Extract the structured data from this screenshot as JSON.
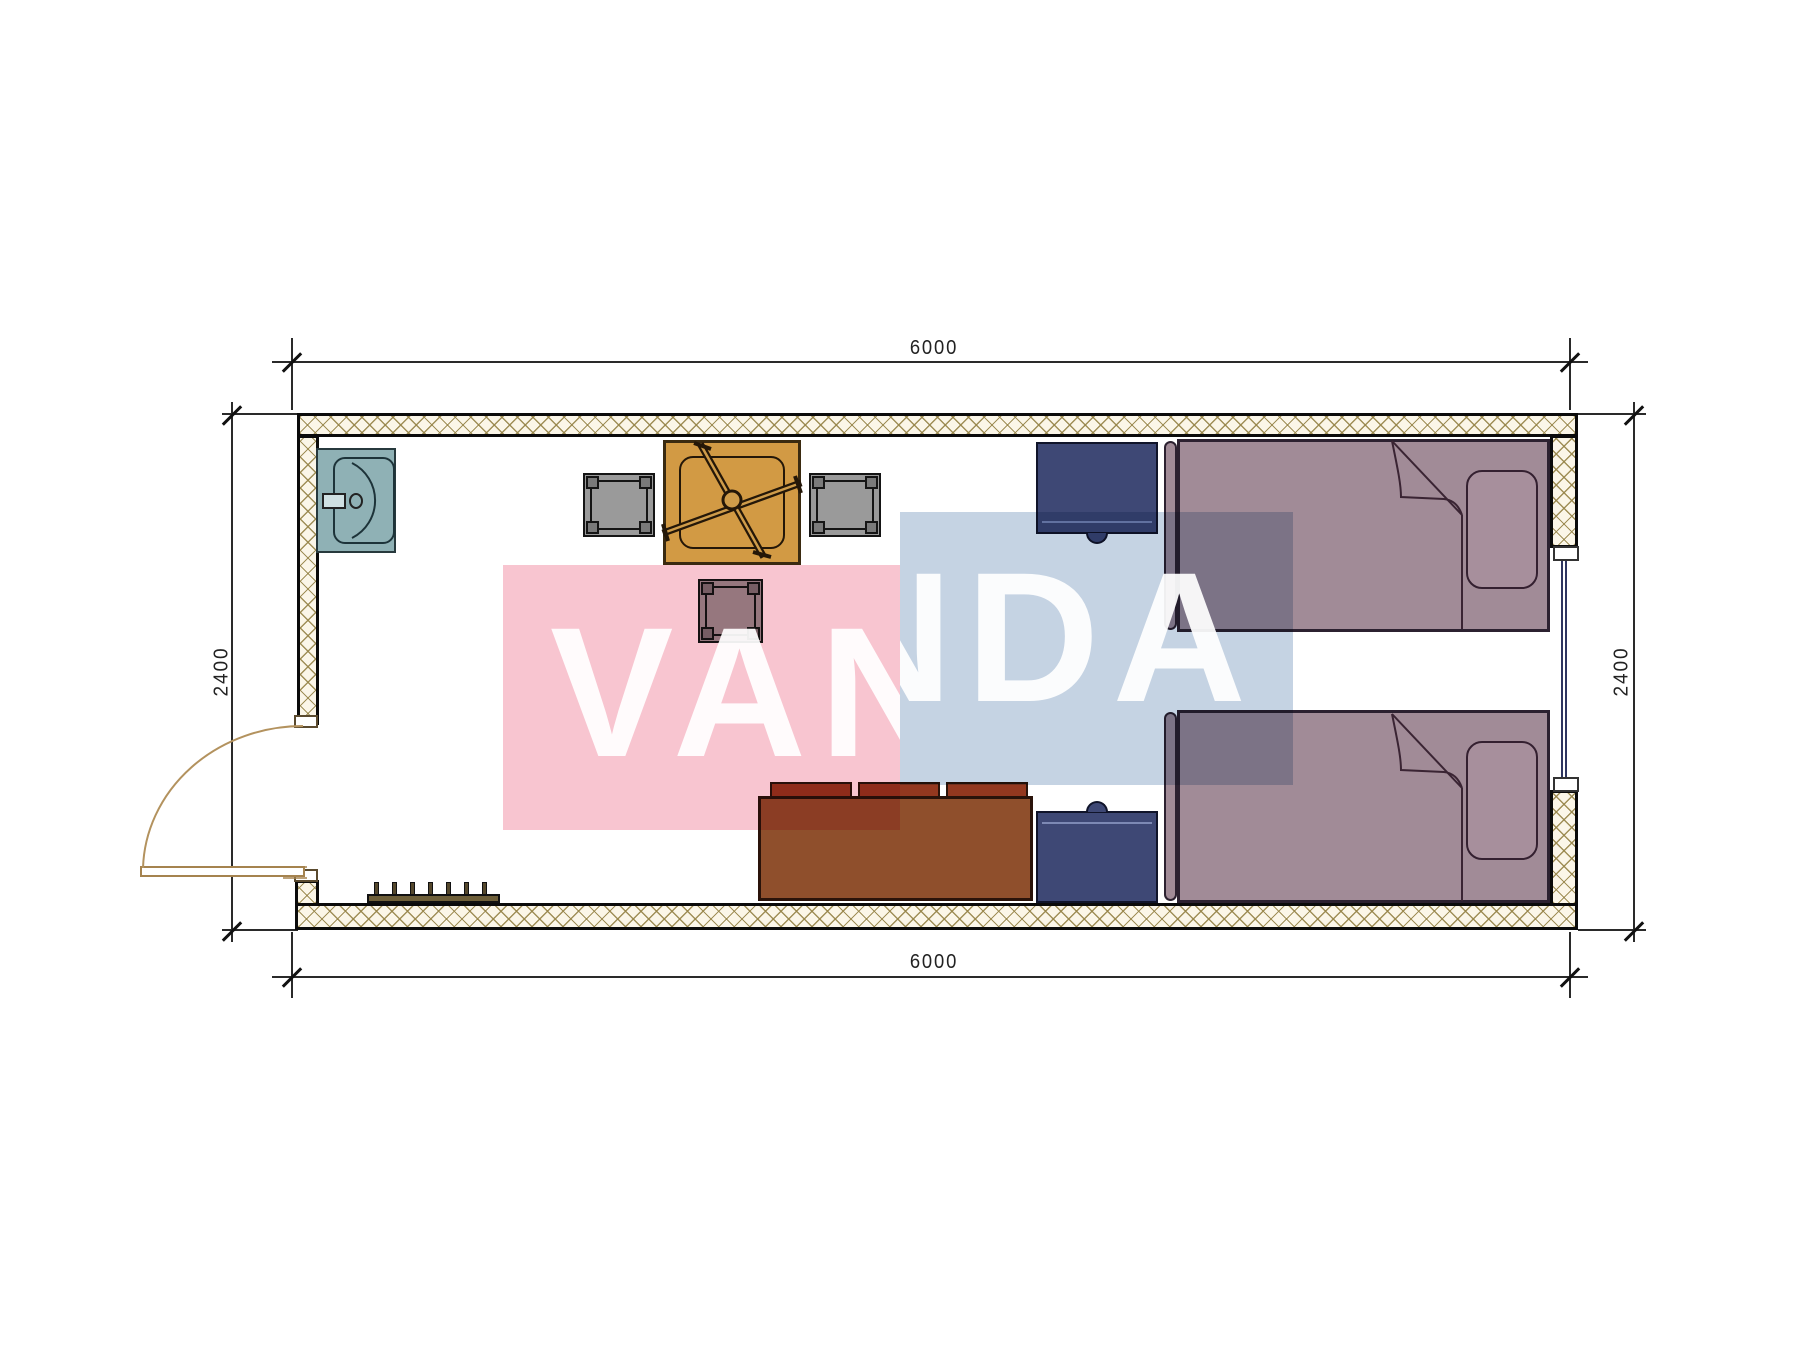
{
  "dimensions": {
    "top": "6000",
    "bottom": "6000",
    "left": "2400",
    "right": "2400"
  },
  "watermark": {
    "word": "VANDA",
    "pink_tile_color": "#f8c5d0",
    "blue_tile_color": "#c5d3e3",
    "text_color": "#ffffff"
  },
  "plan": {
    "type": "floor-plan",
    "room_outer_size_mm": {
      "width": 6000,
      "depth": 2400
    },
    "items": [
      {
        "name": "sink",
        "color": "#8fb1b5"
      },
      {
        "name": "dining-table-with-fan",
        "color": "#d29a44"
      },
      {
        "name": "chair-left",
        "color": "#9a9a9a"
      },
      {
        "name": "chair-right",
        "color": "#9a9a9a"
      },
      {
        "name": "chair-bottom",
        "color": "#9a9a9a"
      },
      {
        "name": "single-bed-top",
        "color": "#a18b97"
      },
      {
        "name": "single-bed-bottom",
        "color": "#a18b97"
      },
      {
        "name": "nightstand-top",
        "color": "#3e4875"
      },
      {
        "name": "nightstand-bottom",
        "color": "#3e4875"
      },
      {
        "name": "sofa",
        "color": "#8f4f2c"
      },
      {
        "name": "radiator",
        "color": "#6e5f39"
      },
      {
        "name": "door-swing-left-wall",
        "color": "#b3925e"
      },
      {
        "name": "window-right-wall",
        "color": "#2e3560"
      }
    ],
    "wall_hatch_color": "#96844a",
    "wall_fill": "#fbf6e8"
  }
}
